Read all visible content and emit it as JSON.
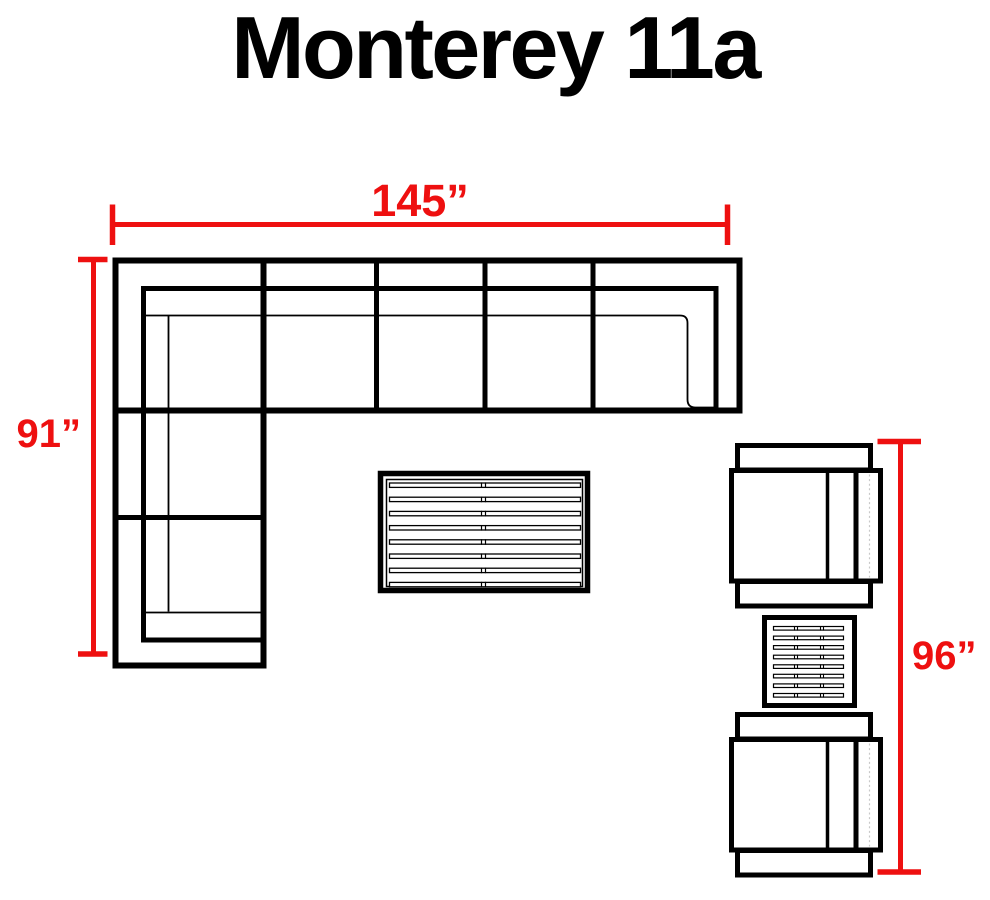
{
  "title": "Monterey 11a",
  "dimensions": {
    "width_label": "145”",
    "left_height_label": "91”",
    "right_height_label": "96”"
  },
  "colors": {
    "dimension_red": "#ee1010",
    "line_black": "#000000",
    "background": "#ffffff"
  },
  "objects": {
    "sectional_sofa": "l-shaped-sectional-sofa-top-view",
    "coffee_table": "slatted-coffee-table-top-view",
    "side_table": "slatted-side-table-top-view",
    "chair_top": "club-chair-top-view",
    "chair_bottom": "club-chair-top-view"
  }
}
